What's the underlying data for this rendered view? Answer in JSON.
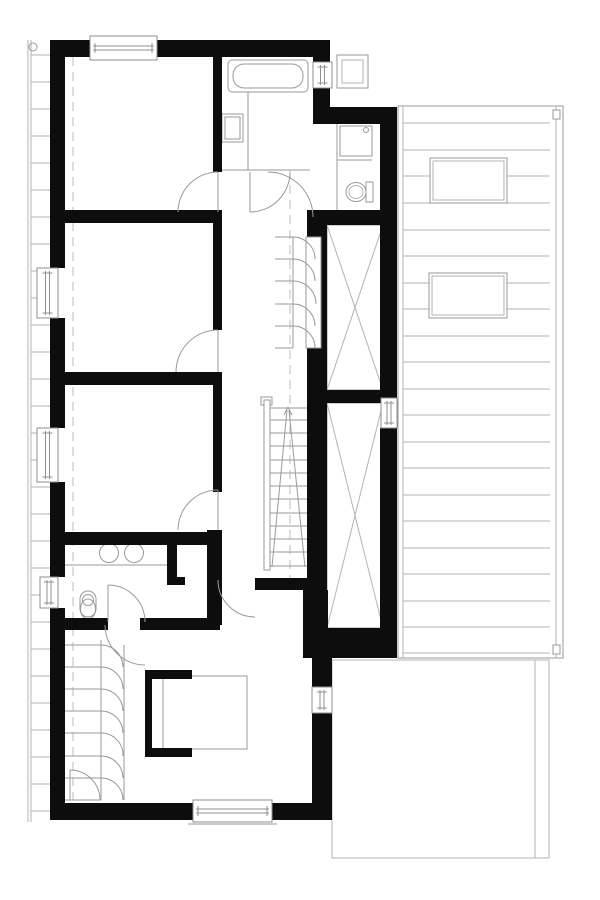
{
  "colors": {
    "wall": "#0d0d0d",
    "line": "#9a9a9a",
    "faint": "#b3b3b3",
    "dash": "#bdbdbd",
    "bg": "#ffffff",
    "frame": "#8f8f8f"
  },
  "plan": {
    "walls": [
      [
        50,
        40,
        40,
        17
      ],
      [
        157,
        40,
        173,
        17
      ],
      [
        50,
        40,
        15,
        228
      ],
      [
        50,
        318,
        15,
        110
      ],
      [
        50,
        482,
        15,
        95
      ],
      [
        50,
        608,
        15,
        212
      ],
      [
        50,
        803,
        143,
        17
      ],
      [
        272,
        803,
        53,
        17
      ],
      [
        313,
        40,
        17,
        22
      ],
      [
        313,
        88,
        17,
        36
      ],
      [
        313,
        107,
        84,
        17
      ],
      [
        380,
        107,
        17,
        291
      ],
      [
        380,
        428,
        17,
        230
      ],
      [
        307,
        210,
        90,
        15
      ],
      [
        213,
        57,
        9,
        115
      ],
      [
        213,
        212,
        9,
        118
      ],
      [
        213,
        372,
        9,
        120
      ],
      [
        207,
        530,
        15,
        95
      ],
      [
        50,
        210,
        172,
        13
      ],
      [
        50,
        372,
        172,
        13
      ],
      [
        50,
        532,
        170,
        13
      ],
      [
        50,
        618,
        58,
        12
      ],
      [
        140,
        618,
        80,
        12
      ],
      [
        167,
        538,
        10,
        47
      ],
      [
        167,
        577,
        18,
        8
      ],
      [
        255,
        578,
        67,
        12
      ],
      [
        307,
        210,
        20,
        418
      ],
      [
        303,
        590,
        25,
        40
      ],
      [
        303,
        628,
        94,
        30
      ],
      [
        327,
        390,
        70,
        13
      ],
      [
        312,
        658,
        20,
        29
      ],
      [
        312,
        713,
        20,
        107
      ],
      [
        145,
        670,
        7,
        87
      ],
      [
        145,
        670,
        47,
        9
      ],
      [
        145,
        748,
        47,
        9
      ]
    ],
    "white_notches": [
      [
        306,
        237,
        15,
        111
      ]
    ],
    "windows_h": [
      [
        90,
        36,
        67,
        24
      ],
      [
        193,
        800,
        79,
        22
      ]
    ],
    "windows_v": [
      [
        37,
        268,
        21,
        50
      ],
      [
        37,
        428,
        21,
        54
      ],
      [
        40,
        577,
        18,
        31
      ],
      [
        313,
        62,
        19,
        26
      ],
      [
        312,
        687,
        20,
        26
      ],
      [
        381,
        398,
        16,
        30
      ]
    ],
    "faint_lines": [
      [
        248,
        92,
        248,
        170
      ],
      [
        222,
        170,
        310,
        170
      ],
      [
        337,
        124,
        337,
        210
      ],
      [
        337,
        160,
        372,
        160
      ],
      [
        65,
        565,
        167,
        565
      ],
      [
        188,
        824,
        277,
        824
      ],
      [
        293,
        237,
        293,
        348
      ],
      [
        275,
        237,
        293,
        237
      ],
      [
        275,
        259,
        293,
        259
      ],
      [
        275,
        281,
        293,
        281
      ],
      [
        275,
        304,
        293,
        304
      ],
      [
        275,
        326,
        293,
        326
      ],
      [
        275,
        348,
        293,
        348
      ],
      [
        101,
        640,
        101,
        800
      ],
      [
        124,
        645,
        124,
        800
      ],
      [
        65,
        645,
        101,
        645
      ],
      [
        65,
        667,
        101,
        667
      ],
      [
        65,
        689,
        101,
        689
      ],
      [
        65,
        711,
        101,
        711
      ],
      [
        65,
        733,
        101,
        733
      ],
      [
        65,
        756,
        101,
        756
      ],
      [
        65,
        778,
        101,
        778
      ],
      [
        65,
        800,
        101,
        800
      ],
      [
        270,
        408,
        307,
        408
      ],
      [
        163,
        676,
        246,
        712
      ],
      [
        163,
        749,
        246,
        712
      ],
      [
        272,
        567,
        287,
        410
      ],
      [
        305,
        567,
        289,
        410
      ],
      [
        284,
        415,
        288,
        407
      ],
      [
        292,
        415,
        288,
        407
      ],
      [
        345,
        152,
        365,
        132
      ],
      [
        361,
        132,
        365,
        132
      ],
      [
        365,
        132,
        365,
        136
      ]
    ],
    "xbox_rects": [
      [
        327,
        225,
        56,
        165
      ],
      [
        327,
        403,
        56,
        225
      ]
    ],
    "xbox_diagonals": [
      [
        327,
        225,
        383,
        390
      ],
      [
        383,
        225,
        327,
        390
      ],
      [
        327,
        403,
        383,
        628
      ],
      [
        383,
        403,
        327,
        628
      ]
    ],
    "light_rects": [
      [
        163,
        676,
        84,
        73
      ],
      [
        340,
        126,
        32,
        30
      ],
      [
        222,
        114,
        21,
        28
      ],
      [
        225,
        117,
        15,
        22
      ],
      [
        366,
        182,
        7,
        20
      ],
      [
        261,
        397,
        11,
        8
      ],
      [
        264,
        400,
        6,
        170
      ]
    ],
    "double_rects": [
      [
        337,
        55,
        31,
        33,
        5
      ]
    ],
    "tub": {
      "outer": [
        228,
        60,
        80,
        32,
        4
      ],
      "inner": [
        233,
        64,
        70,
        24,
        11
      ]
    },
    "toilet_bottom": {
      "tank": [
        80,
        591,
        16,
        26,
        8
      ],
      "seat": [
        88,
        600,
        5.5
      ],
      "bowl": [
        88,
        609,
        7.5,
        10
      ]
    },
    "toilet_wc": {
      "outer": [
        356,
        192,
        10,
        9.5
      ],
      "inner": [
        356,
        192,
        7,
        6.5
      ]
    },
    "circles": [
      [
        109,
        553,
        9.5
      ],
      [
        134,
        553,
        9.5
      ],
      [
        33,
        47,
        4
      ],
      [
        366,
        130,
        2.5
      ]
    ],
    "stair_treads": {
      "x1": 270,
      "x2": 307,
      "ys": [
        420,
        433,
        446,
        460,
        473,
        486,
        499,
        513,
        526,
        539,
        552,
        566
      ]
    },
    "door_arcs": [
      "M218,172 A40,40 0 0 0 178,212",
      "M218,330 A42,42 0 0 0 176,372",
      "M218,490 A40,40 0 0 0 178,530",
      "M250,212 A40,40 0 0 0 290,172",
      "M268,172 A45,45 0 0 1 313,217",
      "M108,585 A37,37 0 0 1 145,622",
      "M105,625 A40,40 0 0 0 145,665",
      "M218,580 A37,37 0 0 0 255,617",
      "M70,770 A30,30 0 0 1 100,800"
    ],
    "door_leaves": [
      [
        218,
        172,
        218,
        212
      ],
      [
        218,
        330,
        218,
        372
      ],
      [
        218,
        490,
        218,
        530
      ],
      [
        250,
        172,
        250,
        212
      ],
      [
        108,
        585,
        108,
        622
      ],
      [
        70,
        770,
        70,
        800
      ]
    ],
    "closet_arcs": [
      "M293,237 A22,22 0 0 1 315,259",
      "M293,259 A22,22 0 0 1 315,281",
      "M293,281 A23,23 0 0 1 316,304",
      "M293,304 A22,22 0 0 1 315,326",
      "M293,326 A22,22 0 0 1 315,348",
      "M101,645 A22,22 0 0 1 123,667",
      "M101,667 A22,22 0 0 1 123,689",
      "M101,689 A22,22 0 0 1 123,711",
      "M101,711 A22,22 0 0 1 123,733",
      "M101,733 A22,22 0 0 1 123,756",
      "M101,756 A22,22 0 0 1 123,778",
      "M101,778 A22,22 0 0 1 123,800"
    ],
    "dashed": [
      [
        73,
        57,
        73,
        800
      ],
      [
        290,
        170,
        290,
        578
      ]
    ],
    "facade": {
      "v1": [
        28,
        40,
        28,
        822
      ],
      "v2": [
        31,
        40,
        31,
        822
      ],
      "rung_x1": 31,
      "rung_x2": 50,
      "rung_y0": 55,
      "rung_step": 27,
      "rung_count": 29
    },
    "roof": {
      "rect": [
        398,
        106,
        165,
        552
      ],
      "inner_left_x": 403,
      "inner_right_x": 556,
      "line_x1": 403,
      "line_x2": 550,
      "line_ys_full": [
        123,
        150,
        203,
        230,
        256,
        336,
        362,
        389,
        415,
        442,
        468,
        495,
        521,
        548,
        574,
        601,
        627,
        653
      ],
      "line_ys_split": [
        176,
        283,
        309
      ],
      "split_gap": [
        430,
        507
      ],
      "skylights": [
        [
          430,
          158,
          77,
          45
        ],
        [
          429,
          273,
          78,
          45
        ]
      ],
      "skylight_inset": 3,
      "drains": [
        [
          553,
          110,
          7,
          9
        ],
        [
          553,
          645,
          7,
          9
        ]
      ]
    },
    "terrace": {
      "rect": [
        332,
        660,
        217,
        198
      ],
      "inner_x": 535
    }
  }
}
